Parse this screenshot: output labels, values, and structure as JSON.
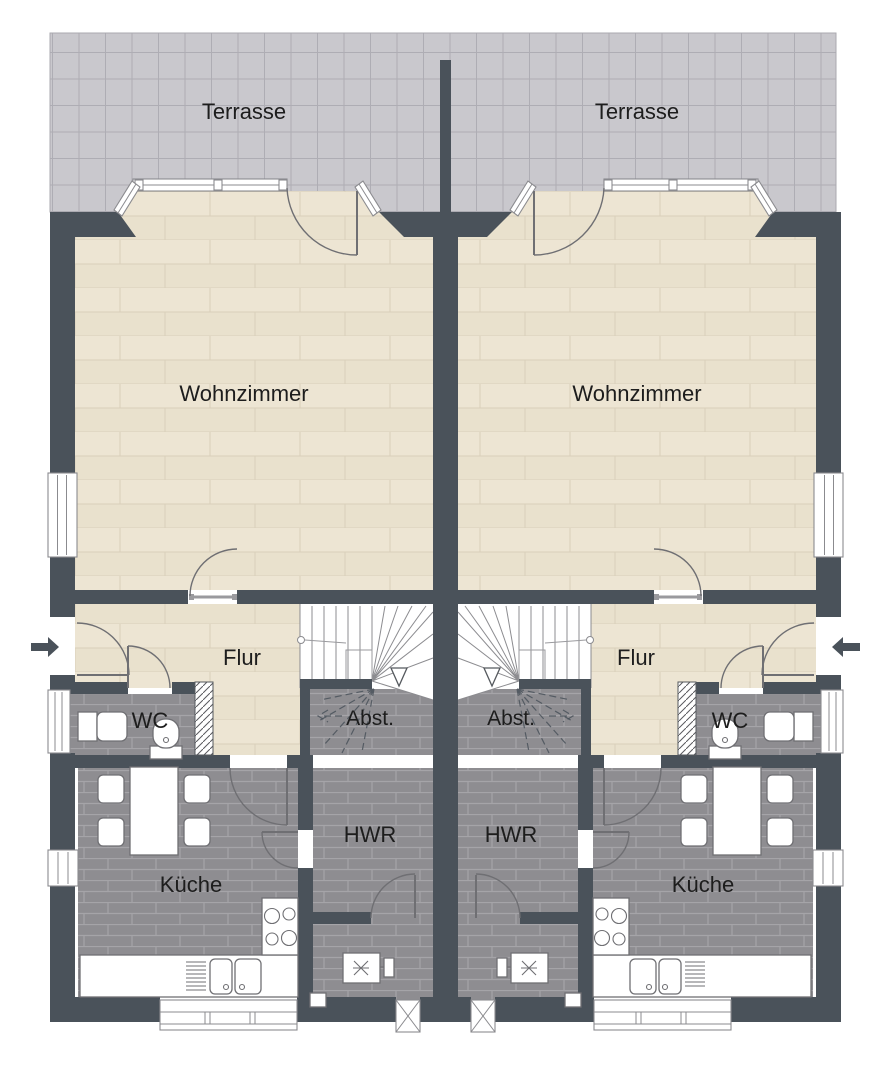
{
  "palette": {
    "background": "#ffffff",
    "wall": "#4a525a",
    "terrace_tile": "#c9c8cd",
    "terrace_grid": "#aeadb4",
    "wood_floor": "#ede5d3",
    "wood_line": "#d9cfba",
    "dark_tile": "#8e8d91",
    "dark_tile_line": "#a5a4a8",
    "door_arc": "#6f6f73",
    "label_text": "#1d1d1d"
  },
  "units": [
    {
      "id": "left",
      "labels": {
        "terrace": "Terrasse",
        "living": "Wohnzimmer",
        "hall": "Flur",
        "wc": "WC",
        "storage": "Abst.",
        "utility": "HWR",
        "kitchen": "Küche"
      }
    },
    {
      "id": "right",
      "labels": {
        "terrace": "Terrasse",
        "living": "Wohnzimmer",
        "hall": "Flur",
        "wc": "WC",
        "storage": "Abst.",
        "utility": "HWR",
        "kitchen": "Küche"
      }
    }
  ]
}
